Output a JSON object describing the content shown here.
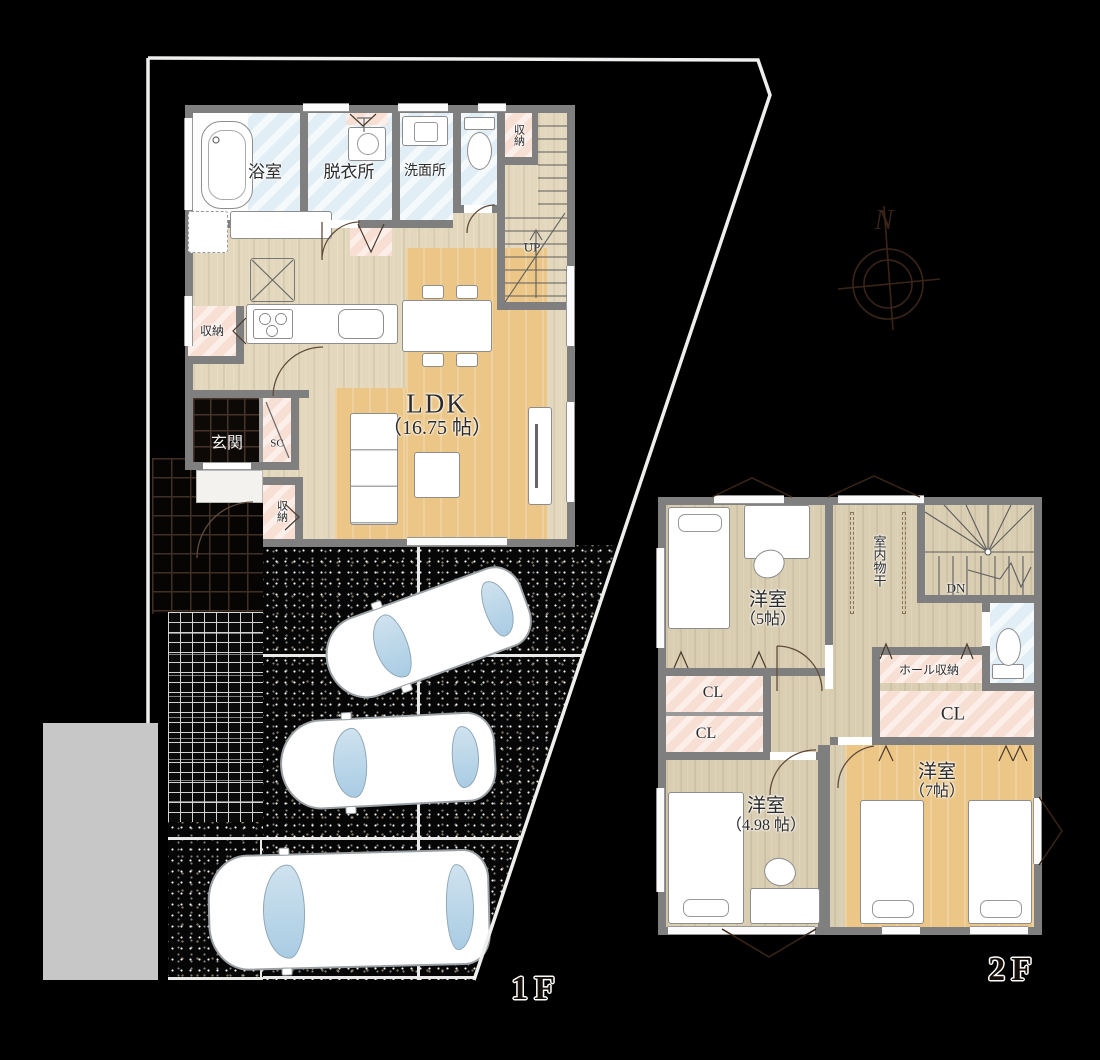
{
  "compass": {
    "north": "N"
  },
  "floor1": {
    "label": "1F",
    "bath": "浴室",
    "dressing": "脱衣所",
    "washroom": "洗面所",
    "toilet_storage": "収納",
    "stairs_up": "UP",
    "kitchen_storage": "収納",
    "entrance": "玄関",
    "shoe_closet": "SC",
    "entrance_storage": "収納",
    "ldk_name": "LDK",
    "ldk_size": "（16.75 帖）"
  },
  "floor2": {
    "label": "2F",
    "bedroom_a_name": "洋室",
    "bedroom_a_size": "（5帖）",
    "drying": "室内物干",
    "stairs_down": "DN",
    "hall_storage": "ホール収納",
    "closet_a": "CL",
    "closet_b": "CL",
    "closet_c": "CL",
    "bedroom_b_name": "洋室",
    "bedroom_b_size": "（4.98 帖）",
    "bedroom_c_name": "洋室",
    "bedroom_c_size": "（7帖）"
  },
  "colors": {
    "background": "#000000",
    "wall_gray": "#7f7f7f",
    "wood_floor_1f": "#e3d8bd",
    "wood_floor_2f": "#d9cdb2",
    "accent_floor_orange": "#ebc687",
    "wet_area_blue": "#e1eef6",
    "closet_pink": "#f8dfd4",
    "boundary_white": "#f0f0ee",
    "linework_brown": "#3a2517"
  }
}
